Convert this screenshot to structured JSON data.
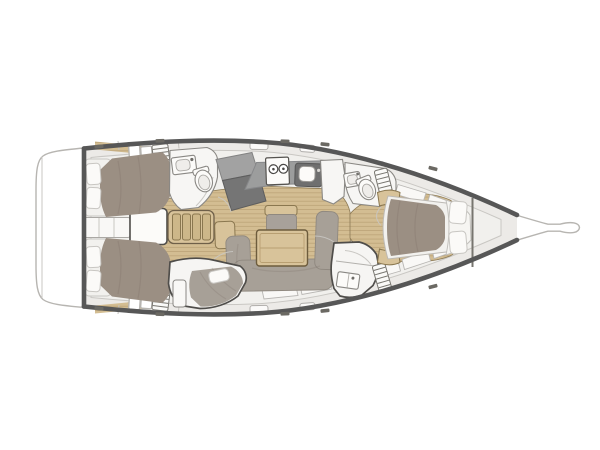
{
  "scene": {
    "title": "Sailboat interior layout plan, top view, bow pointing right",
    "background": "#ffffff"
  },
  "palette": {
    "hull_outline": "#575757",
    "deck": "#eceae7",
    "inner_floor": "#f1f0ed",
    "room": "#f7f6f4",
    "panel": "#f9f8f6",
    "wood": "#d3bd92",
    "wood_line": "#b59c6e",
    "furniture_wood": "#d8c39a",
    "tread_wood": "#cdb789",
    "bed": "#9b8f83",
    "sofa": "#a7a097",
    "cushion": "#a8a19a",
    "pillow": "#fbfaf8",
    "mattress": "#f2f1ee",
    "counter": "#9c9d9d",
    "unit_light": "#a2a2a2",
    "unit_dark": "#757575",
    "sink_dark": "#6f6f6f",
    "cleat": "#6b6963"
  },
  "features": {
    "swim_platform": 1,
    "bowsprit": 1,
    "aft_cabins": {
      "count": 2,
      "pillows_each": 2
    },
    "companionway_steps": {
      "treads": 4
    },
    "engine_box": 1,
    "aft_head": {
      "washbasin": 1,
      "toilet": 1
    },
    "nav_unit": 1,
    "galley": {
      "stove_burners": 2,
      "sink": 1
    },
    "salon": {
      "table": 1,
      "u_sofa_sections": 3,
      "center_bench": 1
    },
    "utility_cabin": {
      "berth": 1,
      "pillow": 1
    },
    "forward_head": {
      "washbasin": 1,
      "toilet": 1
    },
    "day_head": {
      "washbasin": 1
    },
    "owner_cabin": {
      "island_bed": 1,
      "pillows": 2
    }
  }
}
